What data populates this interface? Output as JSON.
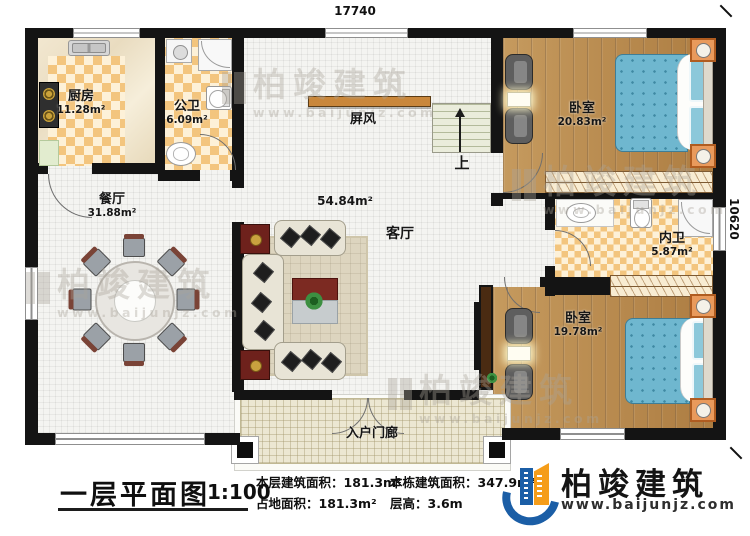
{
  "dimensions": {
    "top": "17740",
    "right": "10620"
  },
  "rooms": {
    "kitchen": {
      "name": "厨房",
      "area": "11.28m²"
    },
    "public_bath": {
      "name": "公卫",
      "area": "6.09m²"
    },
    "dining": {
      "name": "餐厅",
      "area": "31.88m²"
    },
    "living": {
      "name": "客厅",
      "area": "54.84m²"
    },
    "bedroom_top": {
      "name": "卧室",
      "area": "20.83m²"
    },
    "inner_bath": {
      "name": "内卫",
      "area": "5.87m²"
    },
    "bedroom_bottom": {
      "name": "卧室",
      "area": "19.78m²"
    },
    "porch": {
      "name": "入户门廊"
    },
    "screen": {
      "name": "屏风"
    },
    "stairs": {
      "label": "上"
    }
  },
  "footer": {
    "title": "一层平面图",
    "scale": "1:100",
    "stats": {
      "floor_area": {
        "label": "本层建筑面积：",
        "value": "181.3m²"
      },
      "land_area": {
        "label": "占地面积：",
        "value": "181.3m²"
      },
      "building_area": {
        "label": "本栋建筑面积：",
        "value": "347.9m²"
      },
      "floor_height": {
        "label": "层高：",
        "value": "3.6m"
      }
    },
    "brand": {
      "name": "柏竣建筑",
      "url": "www.baijunjz.com"
    }
  },
  "watermark": {
    "name": "柏竣建筑",
    "url": "www.baijunjz.com"
  },
  "colors": {
    "wall": "#141414",
    "brand_blue": "#1b5ea6",
    "brand_orange": "#f59d1a",
    "bed": "#6fb7cf",
    "checker": "#f3c57e"
  }
}
